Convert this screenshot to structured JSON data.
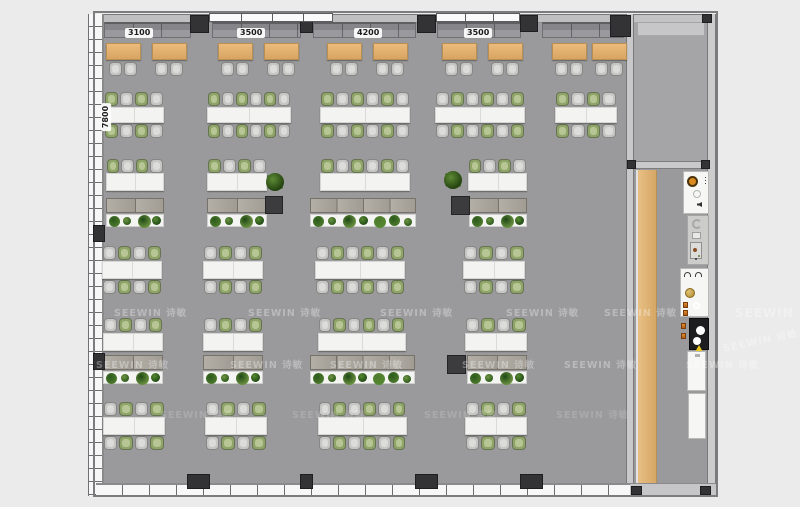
{
  "colors": {
    "bg": "#ebebeb",
    "floor": "#9a9a9c",
    "floor_room": "#a5a5a7",
    "pillar": "#333335",
    "dark_box": "#3c3c3e",
    "chair_gray": "#c6c6c4",
    "chair_green": "#8ea468",
    "table_white": "#f3f3f1",
    "planter": "#f4f4f2",
    "booth_table": "#e0ab6a",
    "wood": "#dcaf74",
    "accent_orange": "#d98a1f",
    "cabinet": "#aba69e",
    "watermark": "#ffffff"
  },
  "dimensions": {
    "top": [
      {
        "text": "3100",
        "cx": 139,
        "y": 28
      },
      {
        "text": "3500",
        "cx": 251,
        "y": 28
      },
      {
        "text": "4200",
        "cx": 368,
        "y": 28
      },
      {
        "text": "3500",
        "cx": 478,
        "y": 28
      }
    ],
    "left": {
      "text": "7800",
      "x": 92,
      "y": 112
    }
  },
  "watermark": {
    "text": "SEEWIN 诗敏",
    "instances": [
      {
        "x": 114,
        "y": 305
      },
      {
        "x": 248,
        "y": 305
      },
      {
        "x": 380,
        "y": 305
      },
      {
        "x": 506,
        "y": 305
      },
      {
        "x": 604,
        "y": 305
      },
      {
        "x": 735,
        "y": 304,
        "size": 12
      },
      {
        "x": 96,
        "y": 357
      },
      {
        "x": 230,
        "y": 357
      },
      {
        "x": 330,
        "y": 357
      },
      {
        "x": 462,
        "y": 357
      },
      {
        "x": 564,
        "y": 357
      },
      {
        "x": 686,
        "y": 357
      },
      {
        "x": 160,
        "y": 407,
        "faint": true
      },
      {
        "x": 292,
        "y": 407,
        "faint": true
      },
      {
        "x": 424,
        "y": 407,
        "faint": true
      },
      {
        "x": 556,
        "y": 407,
        "faint": true
      },
      {
        "x": 722,
        "y": 332,
        "rot": -12,
        "size": 10
      }
    ]
  },
  "floorplan": {
    "bench_y": 22,
    "bench_h": 16,
    "benches": [
      {
        "x": 104,
        "w": 87
      },
      {
        "x": 212,
        "w": 89
      },
      {
        "x": 313,
        "w": 103
      },
      {
        "x": 437,
        "w": 84
      },
      {
        "x": 542,
        "w": 82
      }
    ],
    "booth_tables": {
      "y": 43,
      "h": 17,
      "w": 35,
      "xs": [
        106,
        152,
        218,
        264,
        327,
        373,
        442,
        488,
        552,
        592
      ]
    },
    "booth_chair_y": 62,
    "rows": [
      {
        "chairs_y": 92,
        "table_y": 107,
        "table_h": 16,
        "bottom_y": 124,
        "clusters": [
          {
            "x": 104,
            "w": 60,
            "n": 4,
            "start": "green"
          },
          {
            "x": 207,
            "w": 84,
            "n": 6,
            "start": "green"
          },
          {
            "x": 320,
            "w": 90,
            "n": 6,
            "start": "green"
          },
          {
            "x": 435,
            "w": 90,
            "n": 6,
            "start": "gray"
          },
          {
            "x": 555,
            "w": 62,
            "n": 4,
            "start": "green"
          }
        ]
      },
      {
        "chairs_y": 159,
        "table_y": 173,
        "table_h": 18,
        "bottom_y": null,
        "clusters": [
          {
            "x": 106,
            "w": 58,
            "n": 4,
            "start": "green"
          },
          {
            "x": 207,
            "w": 60,
            "n": 4,
            "start": "green"
          },
          {
            "x": 320,
            "w": 90,
            "n": 6,
            "start": "green"
          },
          {
            "x": 468,
            "w": 59,
            "n": 4,
            "start": "green"
          }
        ]
      },
      {
        "chairs_y": 246,
        "table_y": 261,
        "table_h": 18,
        "bottom_y": 280,
        "clusters": [
          {
            "x": 102,
            "w": 60,
            "n": 4,
            "start": "gray"
          },
          {
            "x": 203,
            "w": 60,
            "n": 4,
            "start": "gray"
          },
          {
            "x": 315,
            "w": 90,
            "n": 6,
            "start": "gray"
          },
          {
            "x": 463,
            "w": 62,
            "n": 4,
            "start": "gray"
          }
        ]
      },
      {
        "chairs_y": 318,
        "table_y": 333,
        "table_h": 18,
        "bottom_y": null,
        "clusters": [
          {
            "x": 103,
            "w": 60,
            "n": 4,
            "start": "gray"
          },
          {
            "x": 203,
            "w": 60,
            "n": 4,
            "start": "gray"
          },
          {
            "x": 318,
            "w": 88,
            "n": 6,
            "start": "gray"
          },
          {
            "x": 465,
            "w": 62,
            "n": 4,
            "start": "gray"
          }
        ]
      },
      {
        "chairs_y": 402,
        "table_y": 417,
        "table_h": 18,
        "bottom_y": 436,
        "clusters": [
          {
            "x": 103,
            "w": 62,
            "n": 4,
            "start": "gray"
          },
          {
            "x": 205,
            "w": 62,
            "n": 4,
            "start": "gray"
          },
          {
            "x": 318,
            "w": 89,
            "n": 6,
            "start": "gray"
          },
          {
            "x": 465,
            "w": 62,
            "n": 4,
            "start": "gray"
          }
        ]
      }
    ],
    "cabinets": [
      {
        "x": 106,
        "y": 198,
        "w": 58,
        "seg": 2
      },
      {
        "x": 207,
        "y": 198,
        "w": 60,
        "seg": 2
      },
      {
        "x": 310,
        "y": 198,
        "w": 106,
        "seg": 4
      },
      {
        "x": 469,
        "y": 198,
        "w": 58,
        "seg": 2
      },
      {
        "x": 103,
        "y": 355,
        "w": 60,
        "seg": 2
      },
      {
        "x": 203,
        "y": 355,
        "w": 60,
        "seg": 2
      },
      {
        "x": 310,
        "y": 355,
        "w": 105,
        "seg": 4
      },
      {
        "x": 467,
        "y": 355,
        "w": 60,
        "seg": 2
      }
    ],
    "planters": [
      {
        "x": 106,
        "y": 214,
        "w": 58
      },
      {
        "x": 207,
        "y": 214,
        "w": 60
      },
      {
        "x": 310,
        "y": 214,
        "w": 106
      },
      {
        "x": 469,
        "y": 214,
        "w": 58
      },
      {
        "x": 103,
        "y": 371,
        "w": 60
      },
      {
        "x": 203,
        "y": 371,
        "w": 60
      },
      {
        "x": 310,
        "y": 371,
        "w": 105
      },
      {
        "x": 467,
        "y": 371,
        "w": 60
      }
    ],
    "dark_boxes": [
      {
        "x": 265,
        "y": 196,
        "w": 18,
        "h": 18
      },
      {
        "x": 451,
        "y": 196,
        "w": 19,
        "h": 19
      },
      {
        "x": 447,
        "y": 355,
        "w": 19,
        "h": 19
      }
    ],
    "trees": [
      {
        "x": 266,
        "y": 173
      },
      {
        "x": 444,
        "y": 171
      }
    ],
    "pillars_top": [
      {
        "x": 190,
        "w": 19,
        "h": 18
      },
      {
        "x": 300,
        "w": 13,
        "h": 18
      },
      {
        "x": 417,
        "w": 19,
        "h": 18
      },
      {
        "x": 520,
        "w": 18,
        "h": 17
      },
      {
        "x": 610,
        "w": 21,
        "h": 22
      }
    ],
    "pillars_bottom": [
      {
        "x": 187,
        "w": 23
      },
      {
        "x": 300,
        "w": 13
      },
      {
        "x": 415,
        "w": 23
      },
      {
        "x": 520,
        "w": 23
      }
    ],
    "pillars_left": [
      {
        "y": 225
      },
      {
        "y": 353
      }
    ],
    "corner_blocks": [
      {
        "x": 702,
        "y": 14,
        "w": 10,
        "h": 9
      },
      {
        "x": 627,
        "y": 160,
        "w": 9,
        "h": 9
      },
      {
        "x": 701,
        "y": 160,
        "w": 9,
        "h": 9
      },
      {
        "x": 631,
        "y": 486,
        "w": 11,
        "h": 9
      },
      {
        "x": 700,
        "y": 486,
        "w": 11,
        "h": 9
      }
    ],
    "windows_top": [
      {
        "x": 209,
        "w": 124,
        "tick": 31
      },
      {
        "x": 436,
        "w": 84,
        "tick": 28
      }
    ],
    "pantry": [
      {
        "kind": "a",
        "x": 683,
        "y": 171,
        "w": 26,
        "h": 43,
        "bg": "white"
      },
      {
        "kind": "b",
        "x": 687,
        "y": 215,
        "w": 22,
        "h": 50,
        "bg": "gray"
      },
      {
        "kind": "c",
        "x": 680,
        "y": 268,
        "w": 29,
        "h": 49,
        "bg": "white"
      },
      {
        "kind": "d",
        "x": 689,
        "y": 318,
        "w": 20,
        "h": 32,
        "bg": "black"
      },
      {
        "kind": "e",
        "x": 687,
        "y": 351,
        "w": 19,
        "h": 40,
        "bg": "white"
      },
      {
        "kind": "f",
        "x": 688,
        "y": 393,
        "w": 18,
        "h": 46,
        "bg": "white"
      }
    ]
  }
}
